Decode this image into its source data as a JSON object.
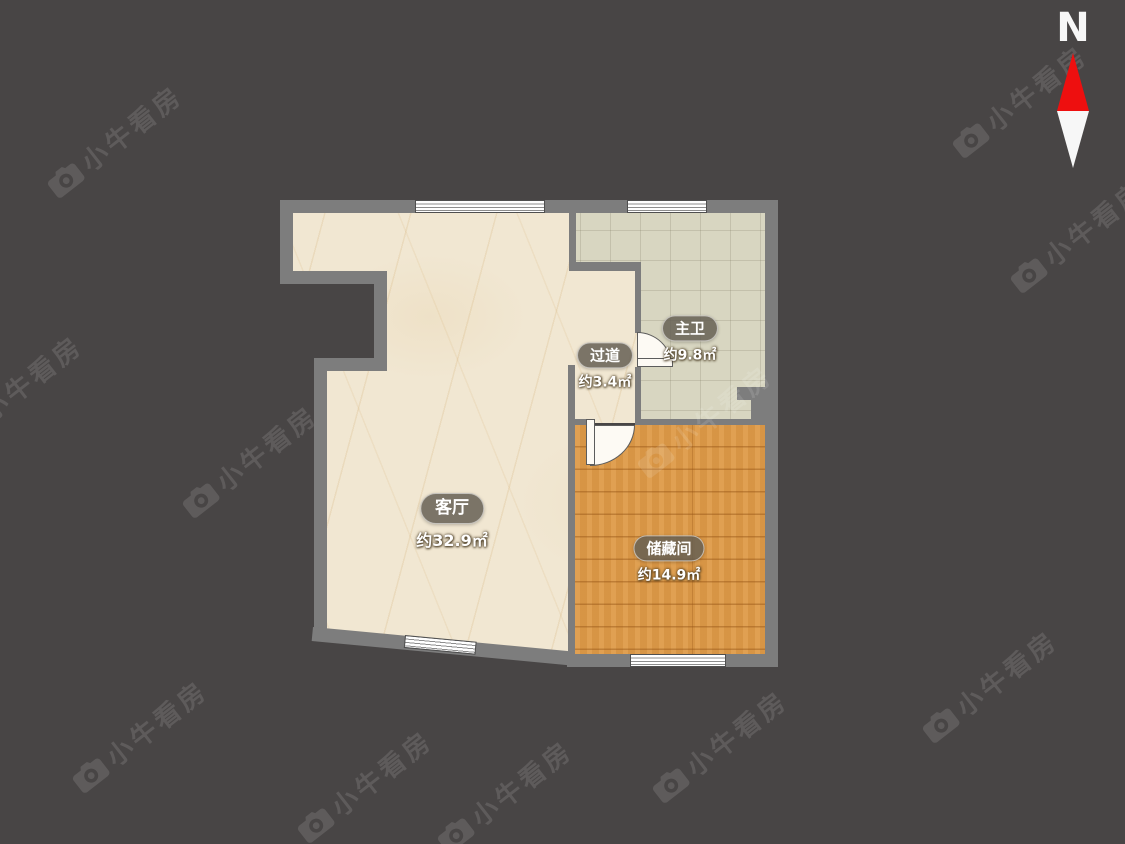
{
  "meta": {
    "type": "residential floor plan"
  },
  "compass": {
    "north_label": "N"
  },
  "watermark": {
    "text": "小牛看房",
    "icon": "camera-logo-icon",
    "positions": [
      {
        "x": 115,
        "y": 140
      },
      {
        "x": 1020,
        "y": 100
      },
      {
        "x": 1078,
        "y": 235
      },
      {
        "x": 15,
        "y": 390
      },
      {
        "x": 705,
        "y": 420
      },
      {
        "x": 250,
        "y": 460
      },
      {
        "x": 140,
        "y": 735
      },
      {
        "x": 365,
        "y": 785
      },
      {
        "x": 505,
        "y": 795
      },
      {
        "x": 720,
        "y": 745
      },
      {
        "x": 990,
        "y": 685
      }
    ]
  },
  "rooms": [
    {
      "id": "living-room",
      "name": "客厅",
      "area": "约32.9㎡"
    },
    {
      "id": "hallway",
      "name": "过道",
      "area": "约3.4㎡"
    },
    {
      "id": "master-bathroom",
      "name": "主卫",
      "area": "约9.8㎡"
    },
    {
      "id": "storage-room",
      "name": "储藏间",
      "area": "约14.9㎡"
    }
  ],
  "palette": {
    "background": "#484545",
    "wall": "#7d7d7d",
    "living_floor": "#f1e7d2",
    "bathroom_floor": "#d8d6c1",
    "storage_floor": "#dc9a49",
    "compass_red": "#ee0f0f",
    "label_text": "#ffffff"
  }
}
